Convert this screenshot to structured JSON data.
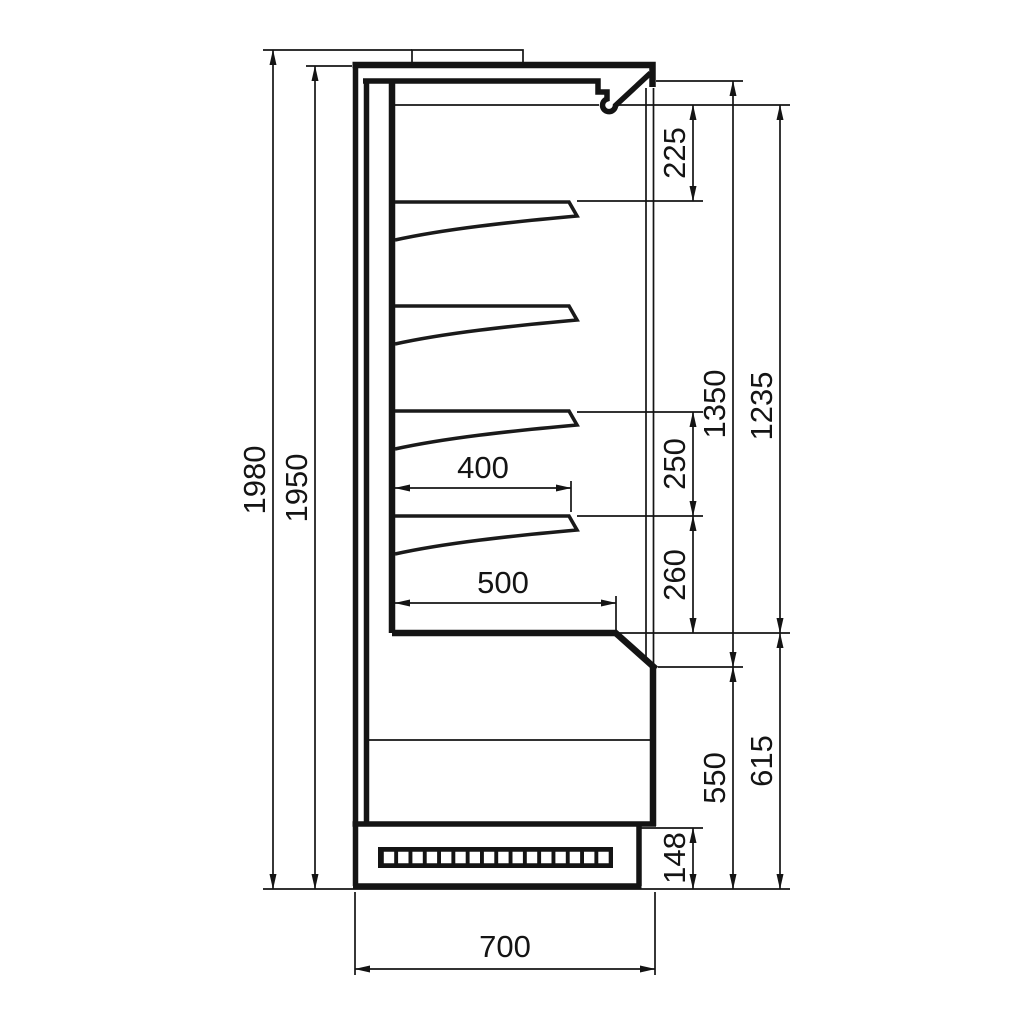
{
  "drawing": {
    "dims": {
      "overall_height": "1980",
      "case_height": "1950",
      "canopy_to_first_shelf": "225",
      "opening_height": "1350",
      "display_height": "1235",
      "shelf_pitch": "250",
      "shelf_to_deck": "260",
      "shelf_depth": "400",
      "deck_depth": "500",
      "lower_front_height": "550",
      "lower_section_height": "615",
      "plinth_height": "148",
      "overall_depth": "700"
    }
  }
}
